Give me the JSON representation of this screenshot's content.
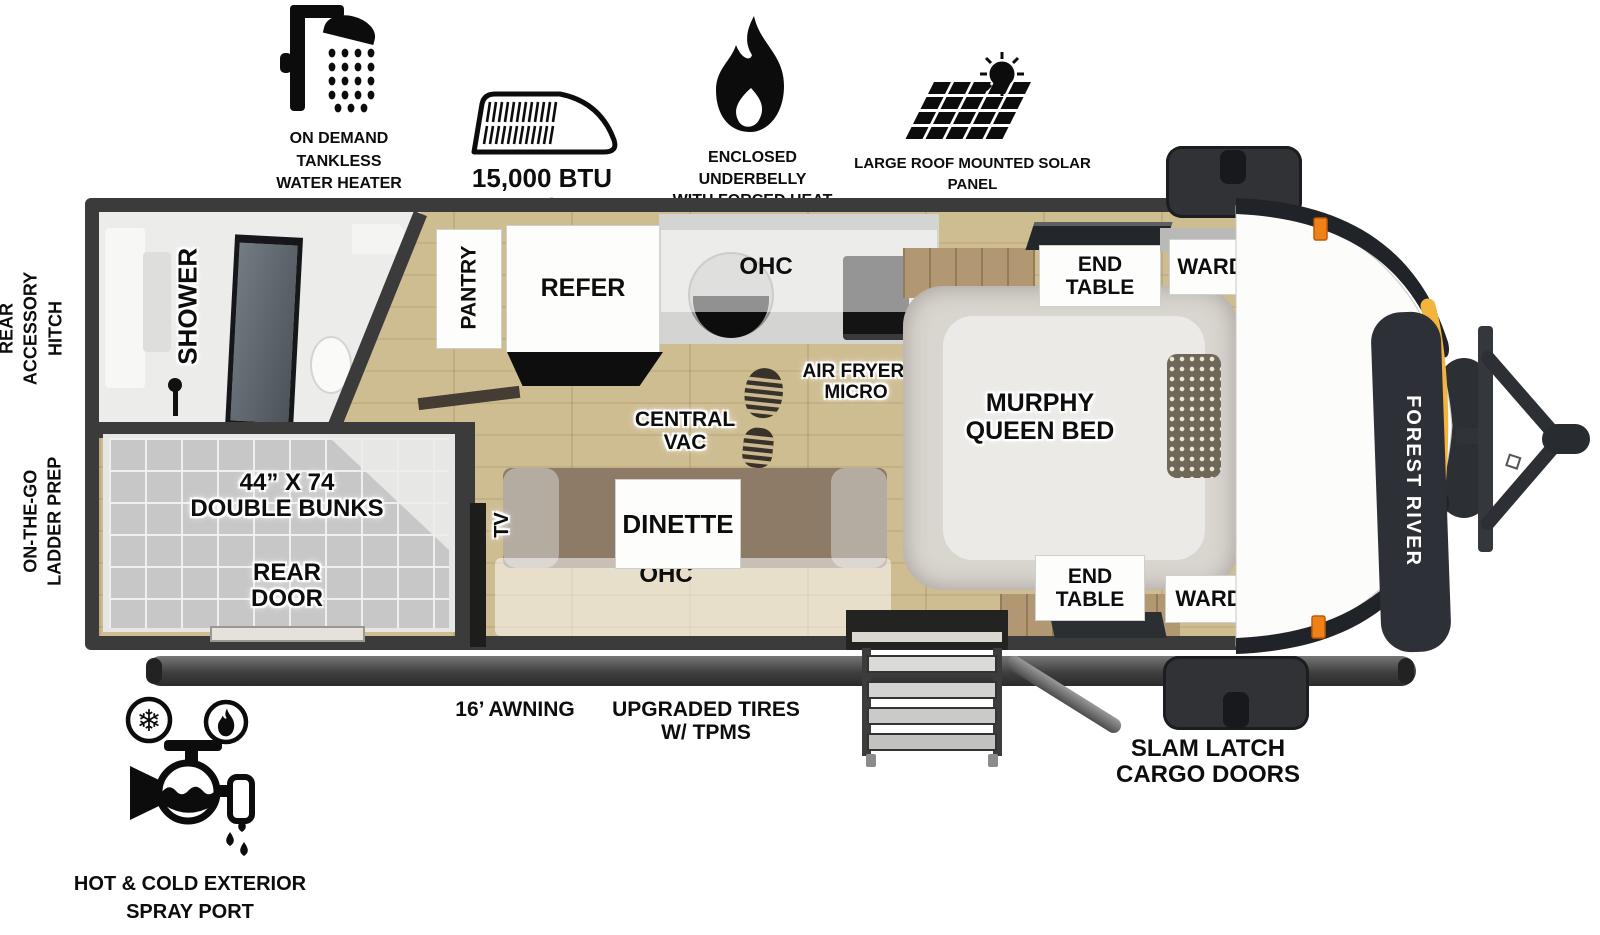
{
  "callouts": {
    "water_heater": {
      "label": "ON DEMAND\nTANKLESS\nWATER HEATER",
      "icon": "shower-icon"
    },
    "ac": {
      "label": "15,000 BTU AC",
      "icon": "rooftop-ac-icon"
    },
    "underbelly": {
      "label": "ENCLOSED UNDERBELLY\nWITH FORCED HEAT",
      "icon": "flame-icon"
    },
    "solar": {
      "label": "LARGE ROOF MOUNTED SOLAR PANEL\n30 AMP CONTROLLER & INVERTER PREP",
      "icon": "solar-panel-icon"
    },
    "rear_accessory_hitch": {
      "label": "REAR\nACCESSORY\nHITCH"
    },
    "ladder_prep": {
      "label": "ON-THE-GO\nLADDER PREP"
    },
    "awning": {
      "label": "16’ AWNING"
    },
    "tires": {
      "label": "UPGRADED TIRES\nW/ TPMS"
    },
    "cargo_doors": {
      "label": "SLAM LATCH\nCARGO DOORS"
    },
    "spray_port": {
      "label": "HOT & COLD EXTERIOR\nSPRAY PORT",
      "icon": "spray-port-icon"
    }
  },
  "rooms": {
    "shower": "SHOWER",
    "pantry": "PANTRY",
    "refer": "REFER",
    "kitchen_ohc": "OHC",
    "air_fryer_micro": "AIR FRYER/\nMICRO",
    "central_vac": "CENTRAL\nVAC",
    "end_table_top": "END\nTABLE",
    "ward_top": "WARD",
    "murphy_bed": "MURPHY\nQUEEN BED",
    "end_table_bottom": "END\nTABLE",
    "ward_bottom": "WARD",
    "double_bunks": "44” X 74\nDOUBLE BUNKS",
    "rear_door": "REAR\nDOOR",
    "tv": "TV",
    "dinette": "DINETTE",
    "dinette_ohc": "OHC"
  },
  "brand": {
    "front_cap_text": "FOREST RIVER"
  },
  "colors": {
    "wall": "#3b3b3b",
    "floor_wood": "#cdbb90",
    "cap_accent_yellow": "#f3b43f",
    "marker_light_orange": "#f08018",
    "badge_dark": "#2d3137"
  }
}
